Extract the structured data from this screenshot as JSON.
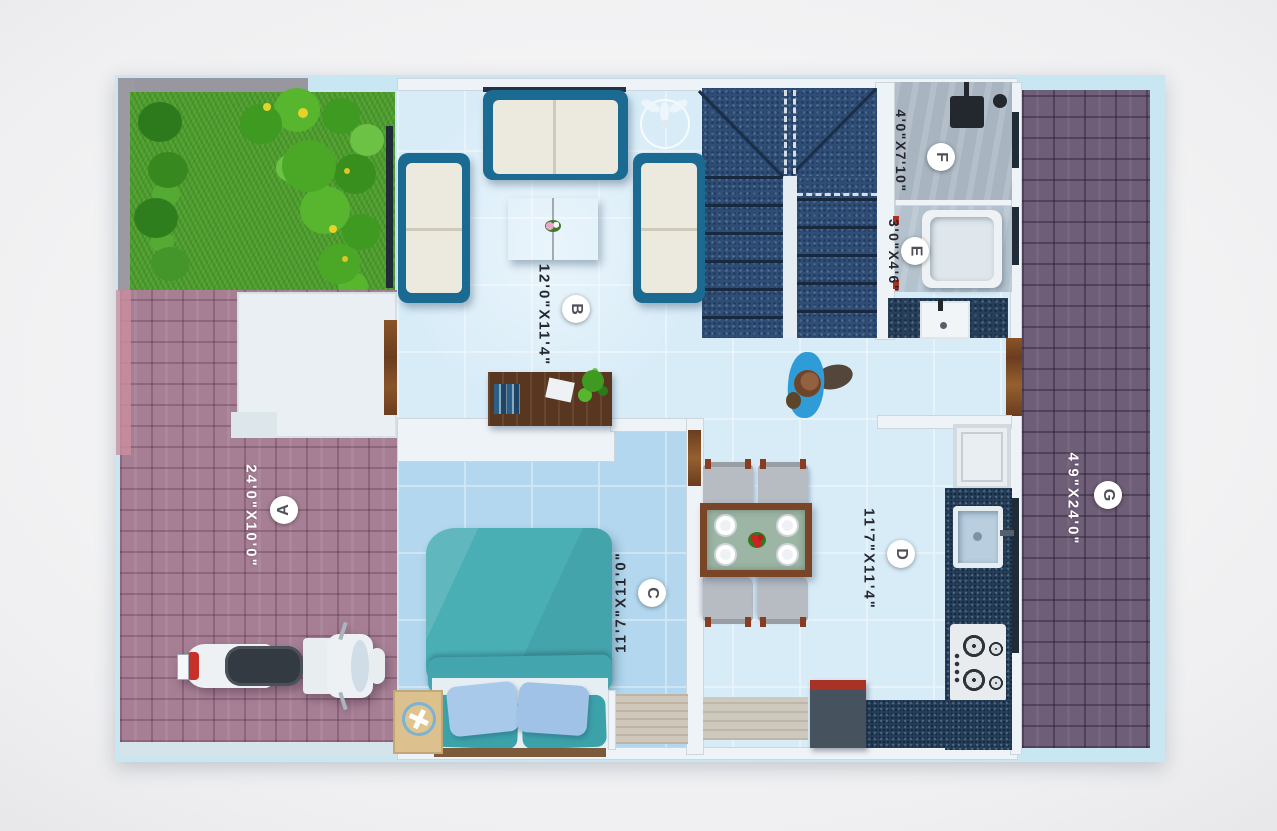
{
  "rooms": [
    {
      "letter": "A",
      "dimensions": "24'0\"X10'0\"",
      "label_text_color": "#ffffff"
    },
    {
      "letter": "B",
      "dimensions": "12'0\"X11'4\"",
      "label_text_color": "#26262e"
    },
    {
      "letter": "C",
      "dimensions": "11'7\"X11'0\"",
      "label_text_color": "#26262e"
    },
    {
      "letter": "D",
      "dimensions": "11'7\"X11'4\"",
      "label_text_color": "#26262e"
    },
    {
      "letter": "E",
      "dimensions": "3'0\"X4'6\"",
      "label_text_color": "#26262e"
    },
    {
      "letter": "F",
      "dimensions": "4'0\"X7'10\"",
      "label_text_color": "#26262e"
    },
    {
      "letter": "G",
      "dimensions": "4'9\"X24'0\"",
      "label_text_color": "#ffffff"
    }
  ],
  "colors": {
    "plan_mat": "#c9e6f3",
    "interior_floor": "#d8ecf8",
    "bedroom_floor": "#b2d7ee",
    "paver_left": "#a77f95",
    "paver_right": "#6e5e77",
    "stairs_granite": "#2e4e77",
    "counter_granite": "#263f5a",
    "grass": "#4f9e2e",
    "sofa_frame": "#1b6a91",
    "bed_teal": "#4aaeb5",
    "wood_door": "#8a5429",
    "accent_red": "#a93226"
  },
  "icons": {
    "ceiling_fan": "3-blade fan",
    "shower": "shower head",
    "badge": "white circle letter marker"
  }
}
